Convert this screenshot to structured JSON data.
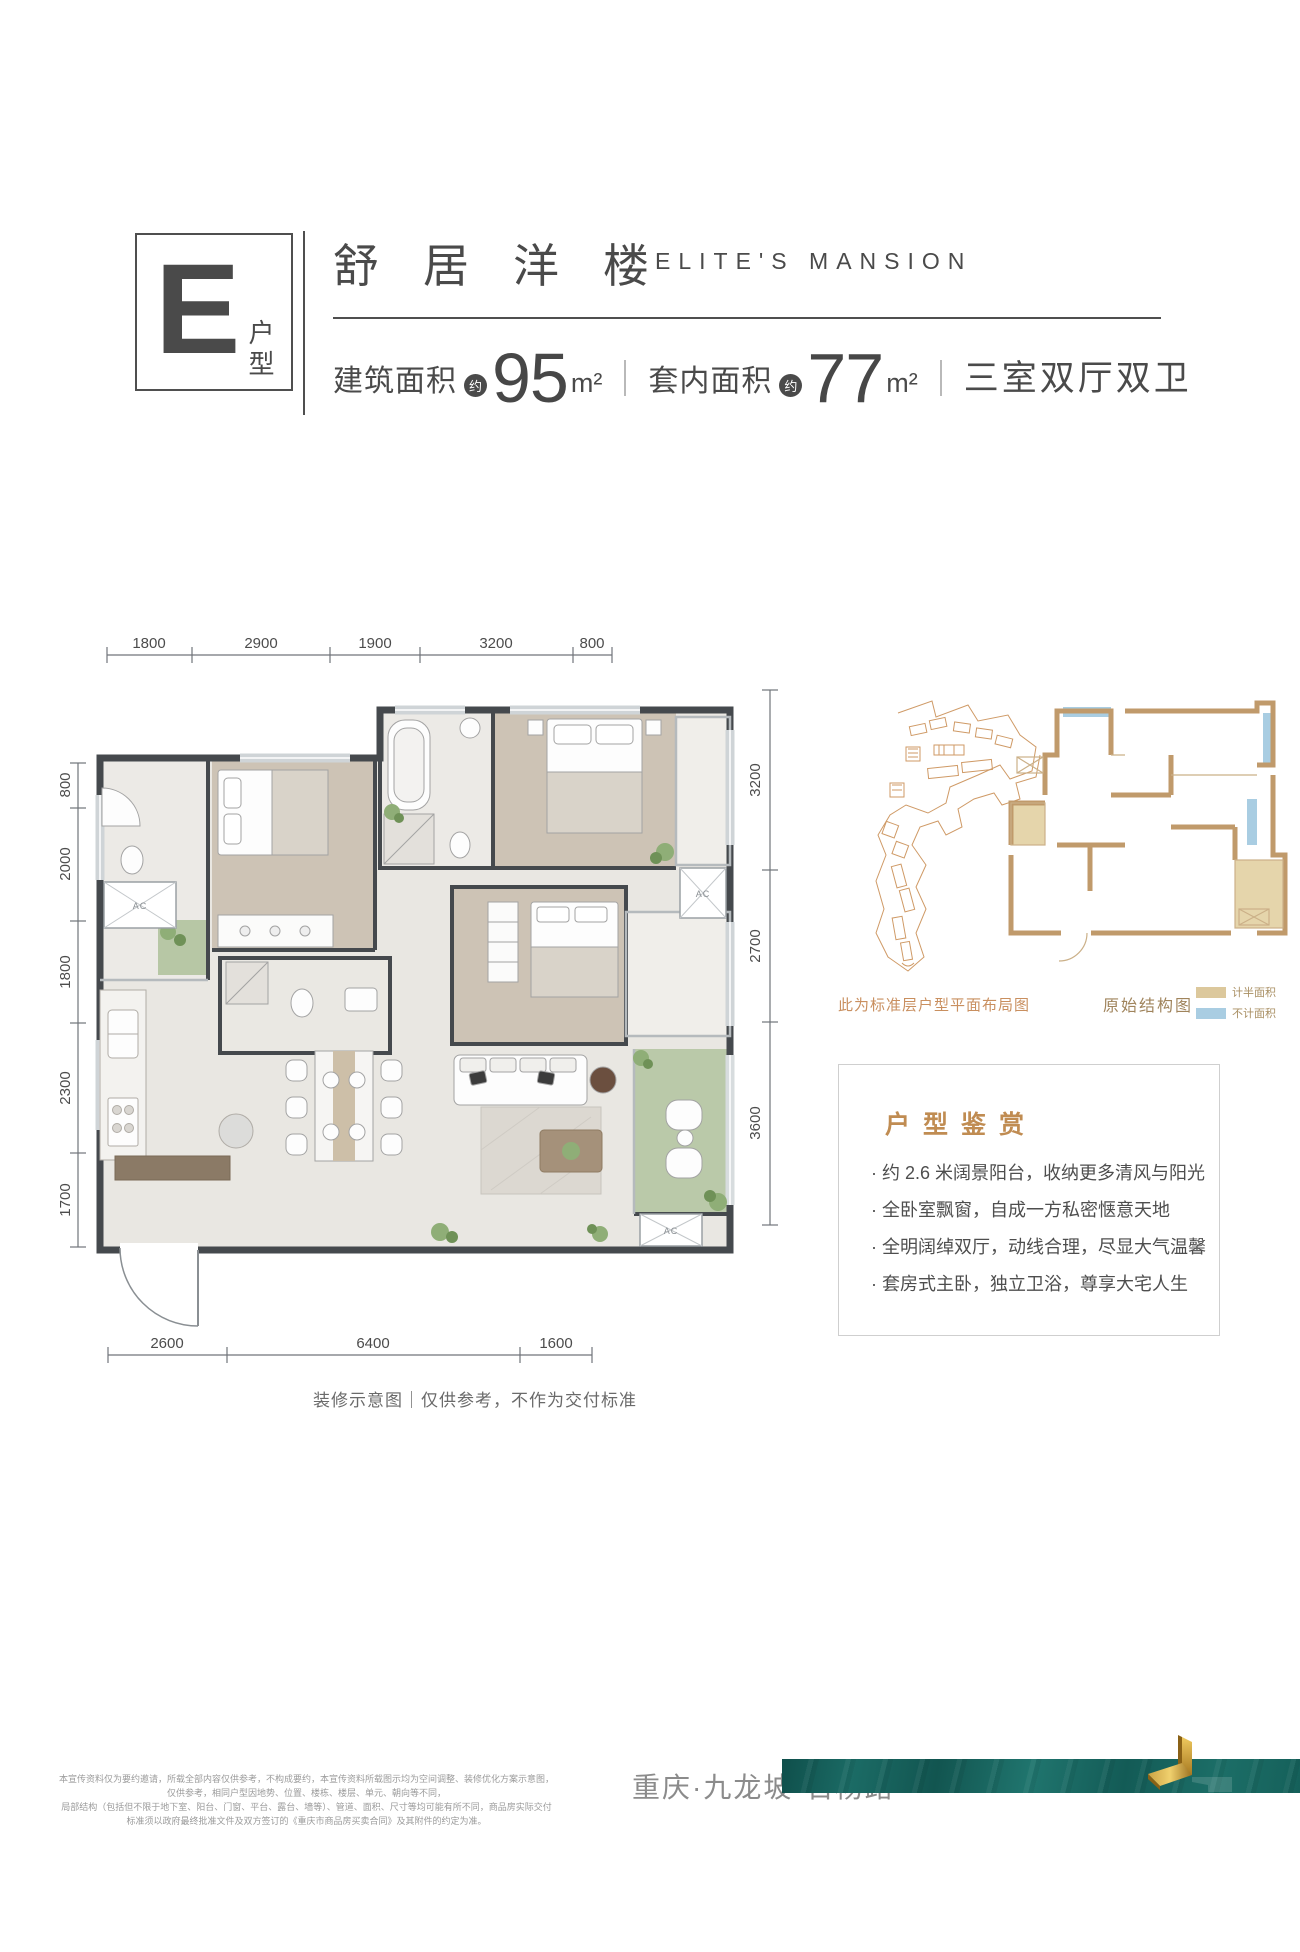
{
  "header": {
    "unit_letter": "E",
    "unit_label": "户型",
    "title_cn": "舒居洋楼",
    "title_en": "ELITE'S MANSION",
    "area1_label": "建筑面积",
    "area1_value": "95",
    "area2_label": "套内面积",
    "area2_value": "77",
    "approx": "约",
    "area_unit": "m²",
    "rooms_label": "三室双厅双卫"
  },
  "floorplan": {
    "dims_top": [
      "1800",
      "2900",
      "1900",
      "3200",
      "800"
    ],
    "dims_left": [
      "800",
      "2000",
      "1800",
      "2300",
      "1700"
    ],
    "dims_right": [
      "3200",
      "2700",
      "3600"
    ],
    "dims_bottom": [
      "2600",
      "6400",
      "1600"
    ],
    "ac_label": "AC",
    "caption": "装修示意图｜仅供参考，不作为交付标准"
  },
  "siteplan": {
    "caption": "此为标准层户型平面布局图"
  },
  "structure": {
    "caption": "原始结构图",
    "legend": [
      {
        "label": "计半面积",
        "color": "#dcc89c"
      },
      {
        "label": "不计面积",
        "color": "#a9cde2"
      }
    ]
  },
  "appreciation": {
    "title": "户型鉴赏",
    "bullets": [
      "· 约 2.6 米阔景阳台，收纳更多清风与阳光",
      "· 全卧室飘窗，自成一方私密惬意天地",
      "· 全明阔绰双厅，动线合理，尽显大气温馨",
      "· 套房式主卧，独立卫浴，尊享大宅人生"
    ]
  },
  "footer": {
    "disclaimer_line1": "本宣传资料仅为要约邀请，所载全部内容仅供参考，不构成要约，本宣传资料所载图示均为空间调整、装修优化方案示意图，仅供参考，相同户型因地势、位置、楼栋、楼层、单元、朝向等不同，",
    "disclaimer_line2": "局部结构（包括但不限于地下室、阳台、门窗、平台、露台、墙等）、管道、面积、尺寸等均可能有所不同，商品房实际交付标准须以政府最终批准文件及双方签订的《重庆市商品房买卖合同》及其附件的约定为准。",
    "location": "重庆·九龙坡·石杨路"
  },
  "colors": {
    "text_dark": "#4a4a4a",
    "accent_gold": "#c08c52",
    "site_orange": "#cf9a66",
    "structure_tan": "#c09a6b",
    "legend_tan": "#dcc89c",
    "legend_blue": "#a9cde2",
    "banner_teal": "#17615c",
    "logo_gold": "#c89a3f",
    "wall_dark": "#45494d"
  }
}
